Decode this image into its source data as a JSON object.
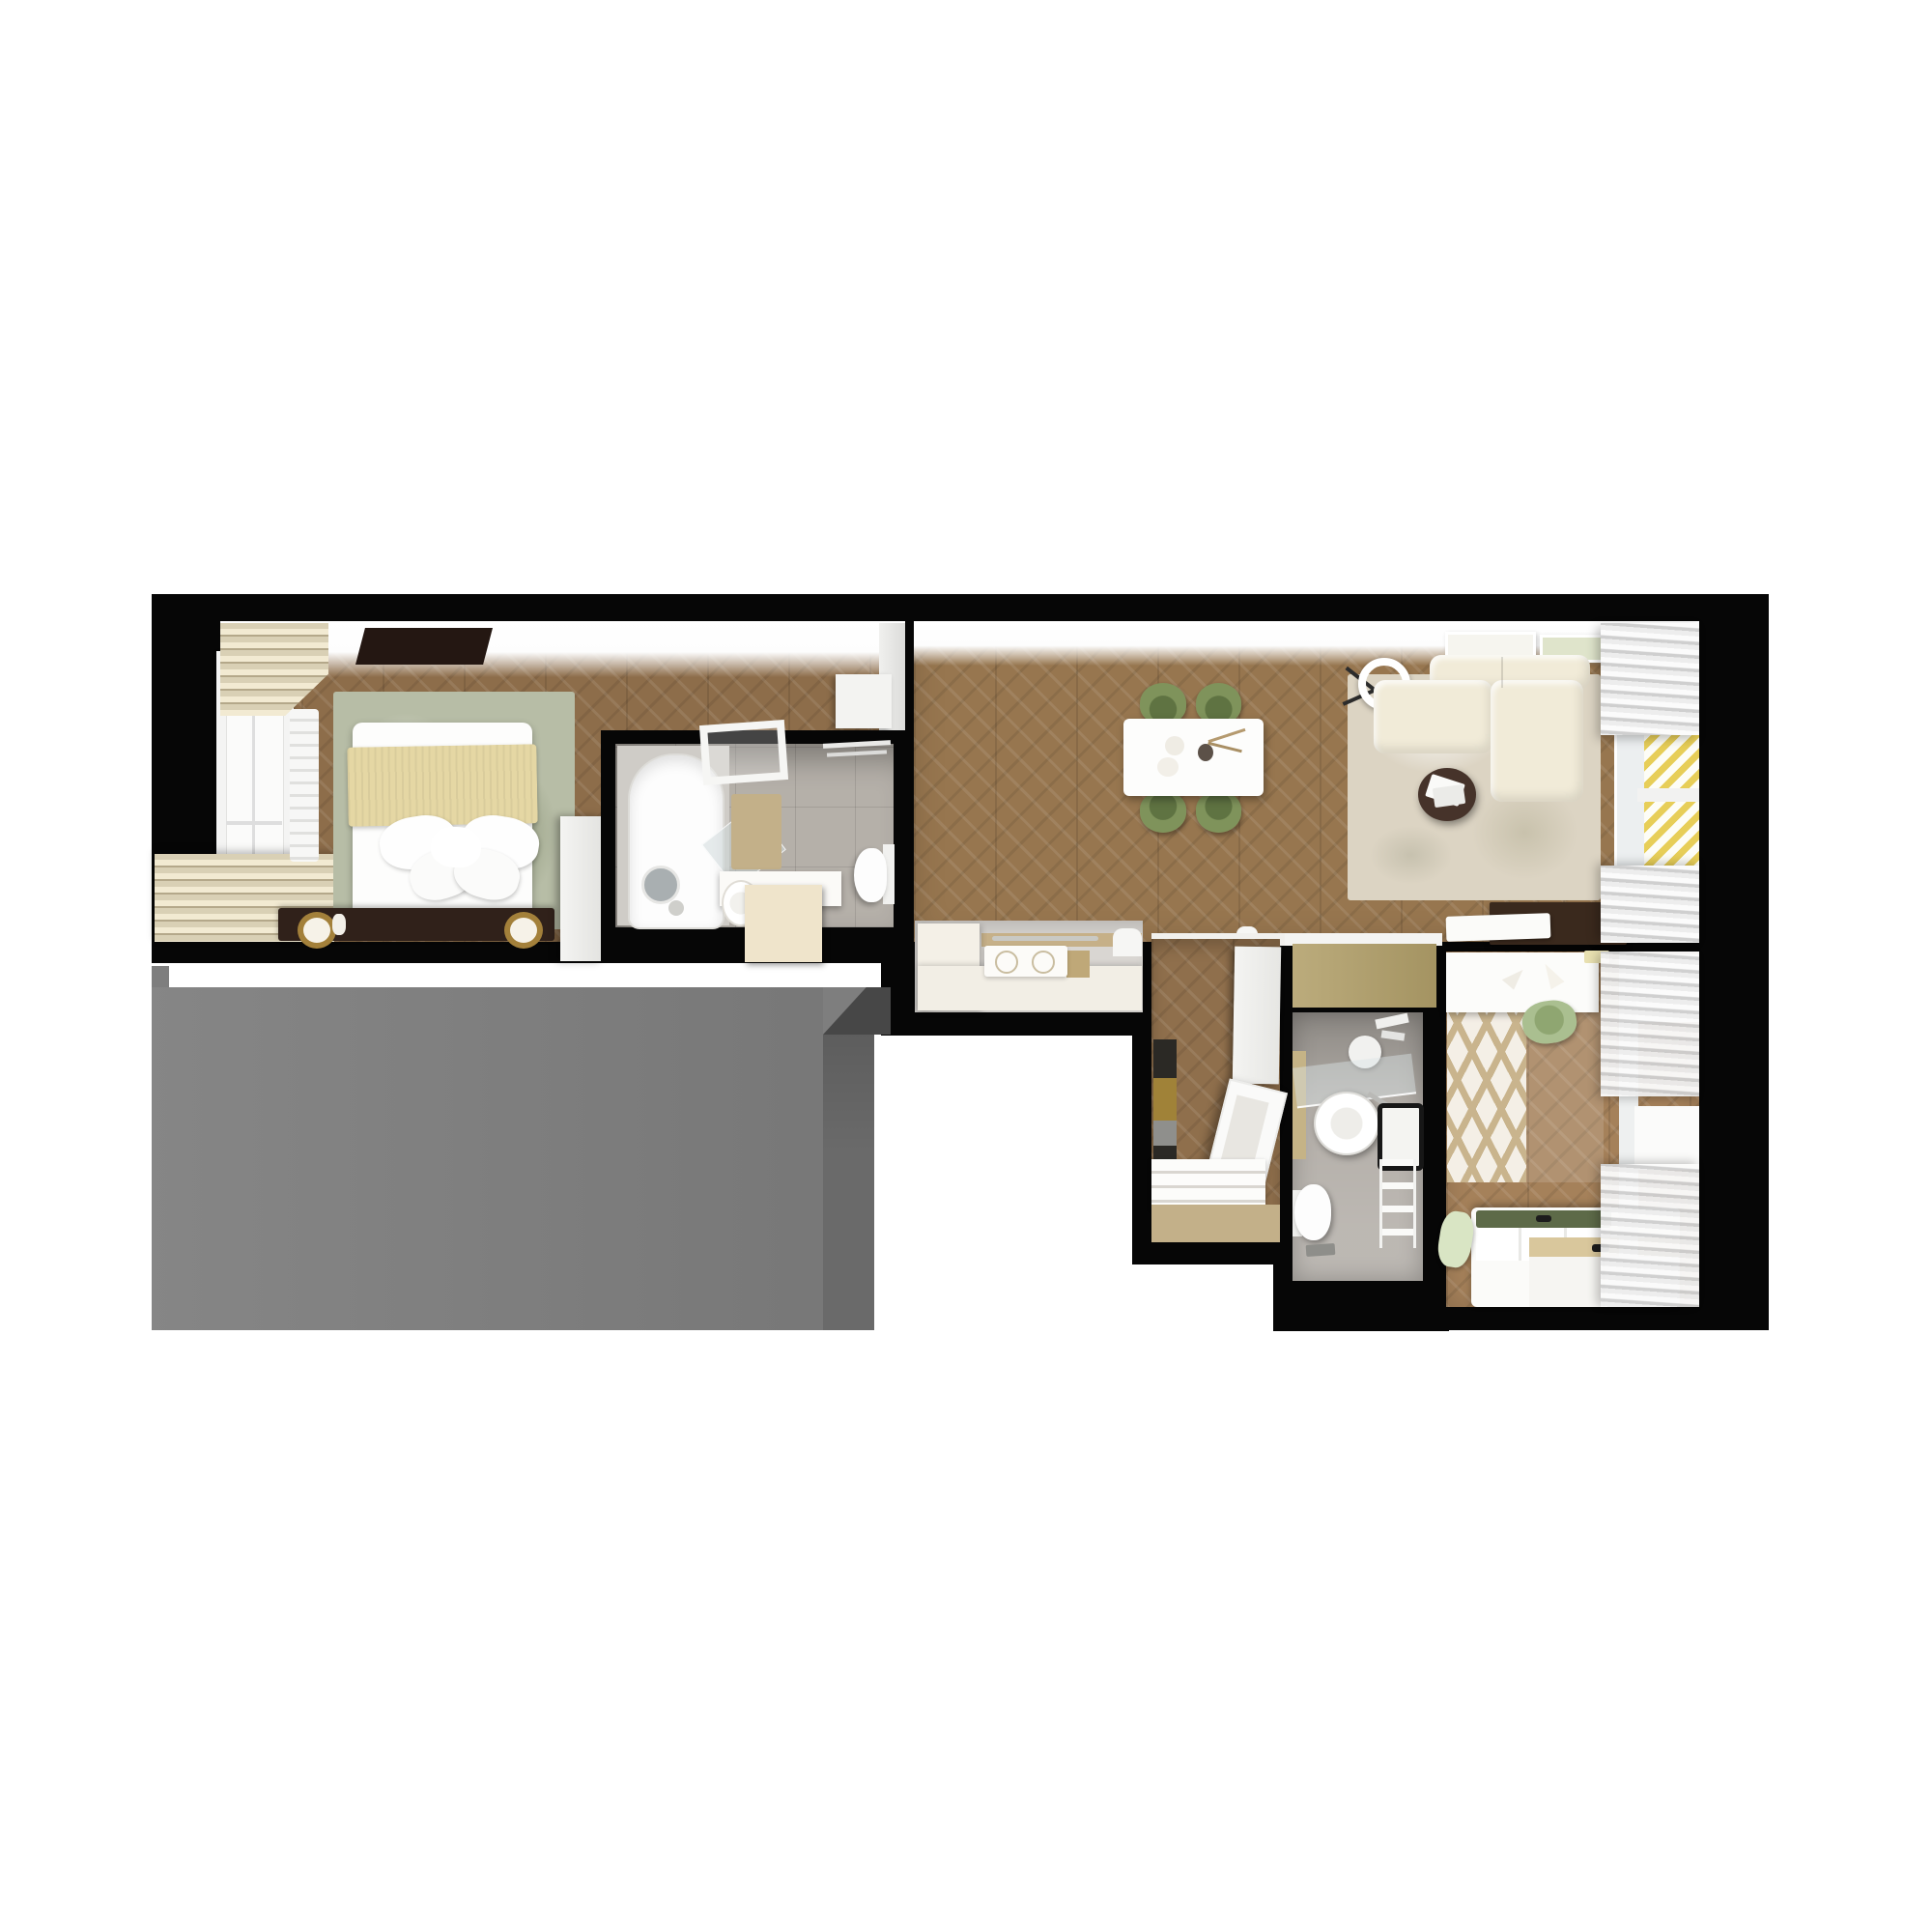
{
  "image_type": "3d-rendered-apartment-floor-plan",
  "view": "top-down dollhouse render, no visible text labels",
  "palette": {
    "bg": "#ffffff",
    "wall": "#060606",
    "neighbor_top": "#7e7e7e",
    "neighbor_side": "#6a6a6a",
    "neighbor_dark": "#474747",
    "wood_bedroom": "#8d6d4a",
    "wood_living": "#97764f",
    "wood_entry": "#8f6f4c",
    "wood_kid": "#a5815a",
    "tile_bath": "#b5b0a9",
    "tile_wc": "#b3aea8",
    "kitchen_floor": "#d9d6d2",
    "khaki": "#b2a06a",
    "khaki_mat": "#c3b089",
    "yellow": "#e7ce58",
    "sofa": "#f1ebd8",
    "chair_green": "#7f935b",
    "sideboard": "#3a291d",
    "coffee_table": "#46332a",
    "rug_green": "#b7bda6",
    "rug_beige": "#dcd4c3",
    "bed_throw": "#e5d7a4",
    "headboard": "#30211a",
    "green_mattress": "#5d6a48",
    "chevron_tan": "#c9b48d",
    "curtain_light": "#fbfbfb",
    "curtain_dark": "#cfcfcf"
  },
  "rooms": [
    {
      "name": "Bedroom",
      "furniture": [
        "double-bed",
        "beige-throw",
        "pillows",
        "headboard-with-lamps",
        "floral-area-rug",
        "window-with-roman-blinds",
        "radiator",
        "wardrobe",
        "dresser",
        "dark-ceiling-light"
      ]
    },
    {
      "name": "Ensuite Bathroom",
      "furniture": [
        "bathtub",
        "round-standing-mirror",
        "glass-screen",
        "bath-mat",
        "vanity-with-round-sink",
        "toilet",
        "towel-bar",
        "ceiling-light-frame"
      ]
    },
    {
      "name": "Living Dining Kitchen",
      "furniture": [
        "dining-table",
        "four-green-chairs",
        "corner-sofa",
        "round-coffee-table-with-magazines",
        "ring-floor-lamp",
        "area-rug",
        "media-sideboard",
        "two-wall-artworks",
        "kitchen-L-counter",
        "cooktop-two-burners",
        "yellow-slatted-window-screen",
        "curtains"
      ]
    },
    {
      "name": "Entry Hall",
      "furniture": [
        "striped-runner-rug",
        "slatted-bench",
        "leaning-mirror",
        "tall-wardrobe",
        "khaki-door-mat",
        "built-in-closet"
      ]
    },
    {
      "name": "WC",
      "furniture": [
        "round-vessel-sink",
        "glass-shelf",
        "black-framed-mirror",
        "towel-ladder",
        "toilet",
        "phone-on-floor",
        "hanging-towel"
      ]
    },
    {
      "name": "Kids Room",
      "furniture": [
        "desk",
        "green-desk-chair",
        "chevron-rug",
        "bed-with-storage-bench",
        "green-mattress-pad",
        "green-pillow",
        "curtains",
        "windows"
      ]
    },
    {
      "name": "Neighboring Unit Slab",
      "furniture": []
    }
  ]
}
